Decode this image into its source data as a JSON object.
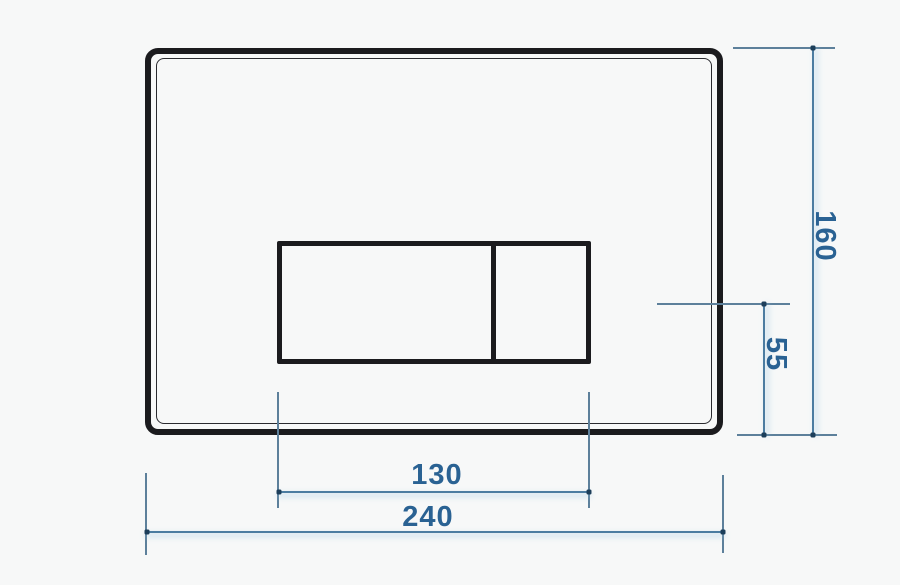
{
  "drawing_labels": {
    "height": "160",
    "button_center_offset": "55",
    "buttons_width": "130",
    "width": "240"
  },
  "colors": {
    "background": "#f7f8f8",
    "outline": "#1b1b1e",
    "outline_thin": "#2a2a2f",
    "dim_line": "#4b7ca1",
    "ext_line": "#5d809b",
    "tick": "#1c3e5a",
    "dim_text": "#2a6293"
  }
}
